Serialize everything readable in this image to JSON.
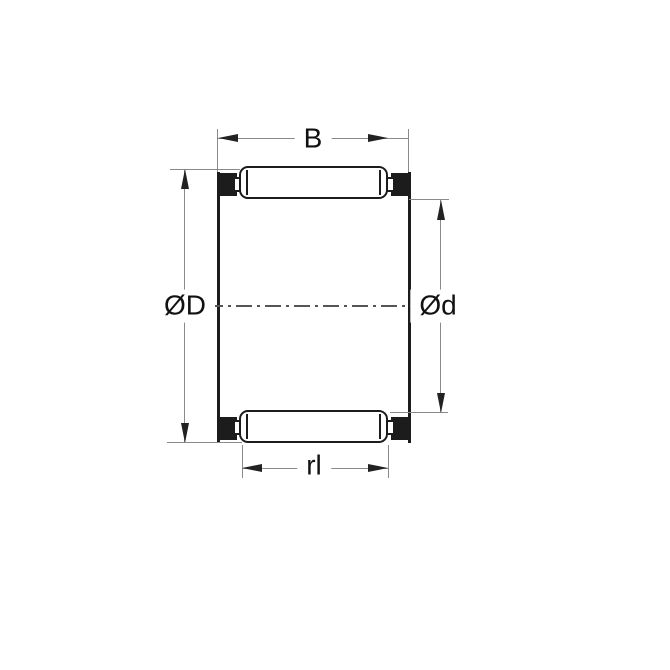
{
  "diagram": {
    "kind": "bearing-dimension-drawing",
    "labels": {
      "width": "B",
      "outer_diameter": "ØD",
      "inner_diameter": "Ød",
      "roller_length": "rl"
    },
    "colors": {
      "background": "#ffffff",
      "outline": "#1c1c1c",
      "dimension_line": "#8a8a8a",
      "arrowhead": "#222222",
      "center_line": "#555555",
      "text": "#111111"
    }
  }
}
